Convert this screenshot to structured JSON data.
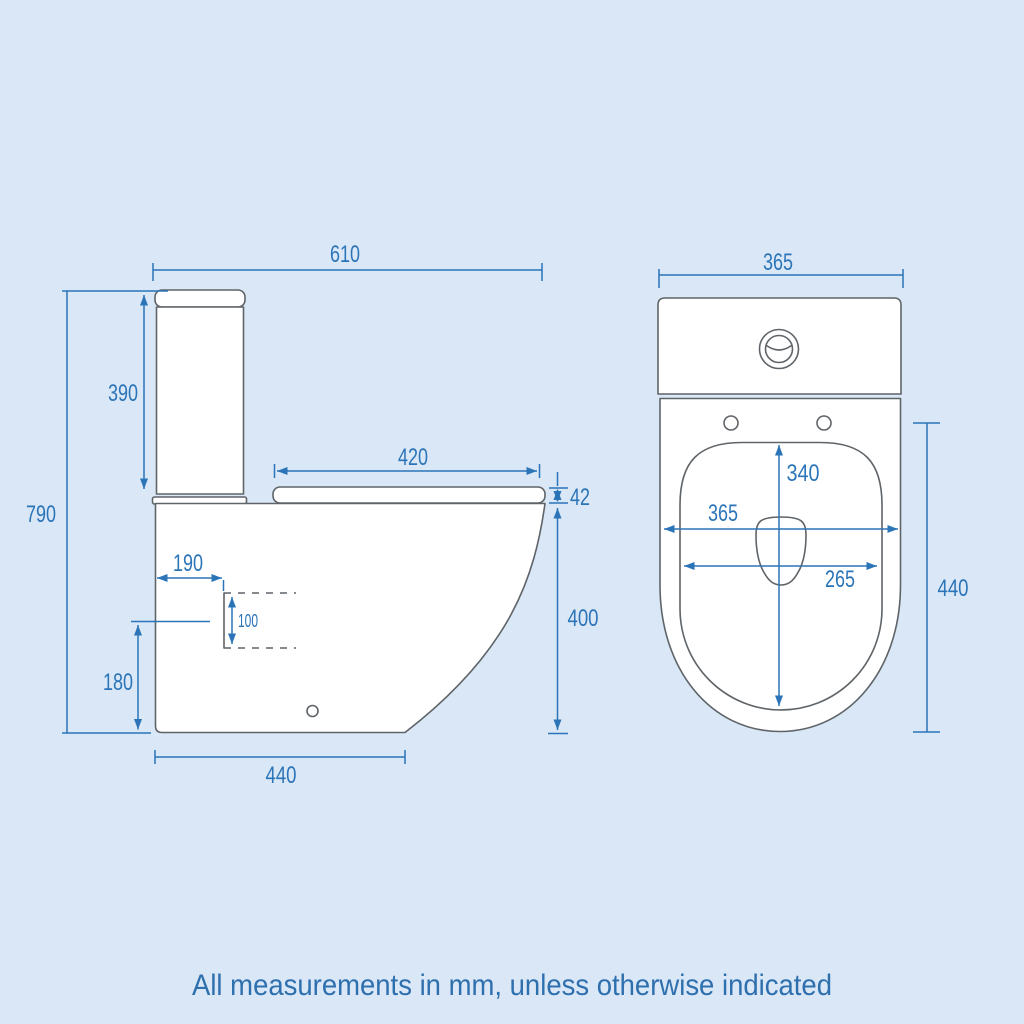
{
  "note": "All measurements in mm, unless otherwise indicated",
  "side_view": {
    "overall_width": "610",
    "overall_height": "790",
    "cistern_height": "390",
    "seat_length": "420",
    "seat_thickness": "42",
    "rim_height": "400",
    "outlet_setback": "190",
    "outlet_size": "100",
    "outlet_height": "180",
    "base_depth": "440"
  },
  "top_view": {
    "cistern_width": "365",
    "seat_opening_depth": "340",
    "bowl_width": "365",
    "seat_opening_width": "265",
    "bowl_depth": "440"
  },
  "colors": {
    "background": "#d9e7f6",
    "outline_gray": "#5f6468",
    "dimension_blue": "#2b74b8",
    "shape_fill": "#ffffff"
  }
}
